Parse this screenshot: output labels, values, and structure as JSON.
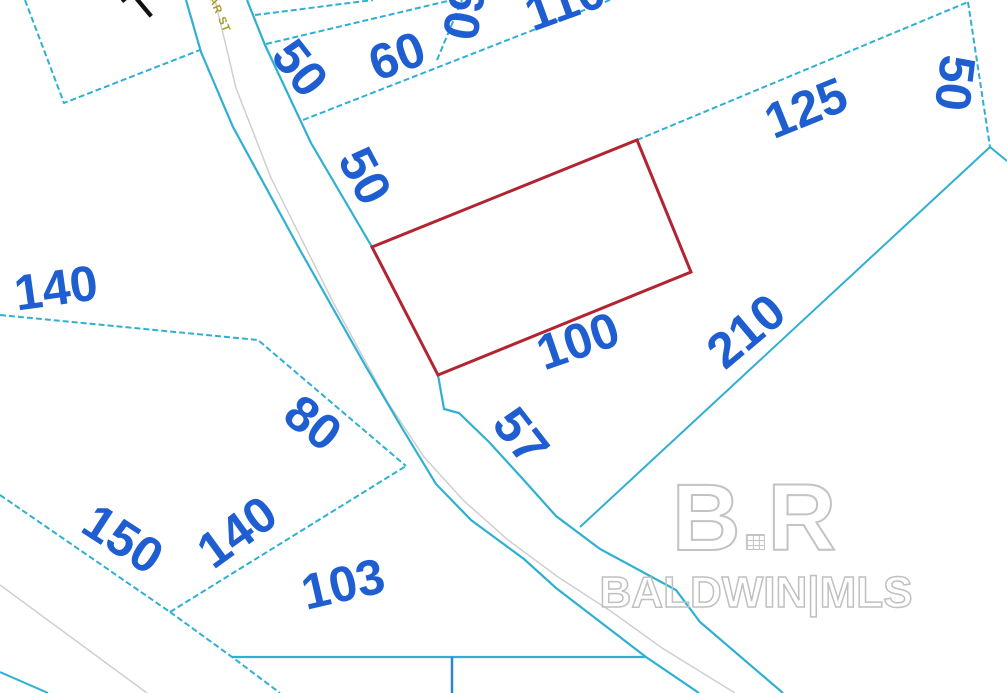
{
  "map_type": "plat-parcel-map",
  "street": {
    "name_fragment": "AR ST",
    "black_text_fragment": "T"
  },
  "labels": [
    {
      "id": "frontage-50-top",
      "text": "50"
    },
    {
      "id": "frontage-60-top",
      "text": "60"
    },
    {
      "id": "depth-60-top",
      "text": "60"
    },
    {
      "id": "dim-110-top",
      "text": "110"
    },
    {
      "id": "dim-125-northeast",
      "text": "125"
    },
    {
      "id": "dim-50-right-edge",
      "text": "50"
    },
    {
      "id": "dim-50-road-frontage",
      "text": "50"
    },
    {
      "id": "dim-140-west",
      "text": "140"
    },
    {
      "id": "dim-100-highlight-south",
      "text": "100"
    },
    {
      "id": "dim-210-southeast",
      "text": "210"
    },
    {
      "id": "dim-80-mid",
      "text": "80"
    },
    {
      "id": "dim-150-southwest",
      "text": "150"
    },
    {
      "id": "dim-140-mid",
      "text": "140"
    },
    {
      "id": "dim-57-road",
      "text": "57"
    },
    {
      "id": "dim-103-south",
      "text": "103"
    }
  ],
  "watermark": {
    "logo_b": "B",
    "logo_r": "R",
    "text": "BALDWIN|MLS"
  },
  "colors": {
    "parcel_line": "#2fb0d2",
    "dimension_text": "#1e5ed0",
    "highlight_parcel_outline": "#b12532",
    "street_text": "#a89a1e",
    "road_centerline": "#cfcfcf",
    "watermark_gray": "#c3c3c3",
    "background": "#ffffff"
  }
}
